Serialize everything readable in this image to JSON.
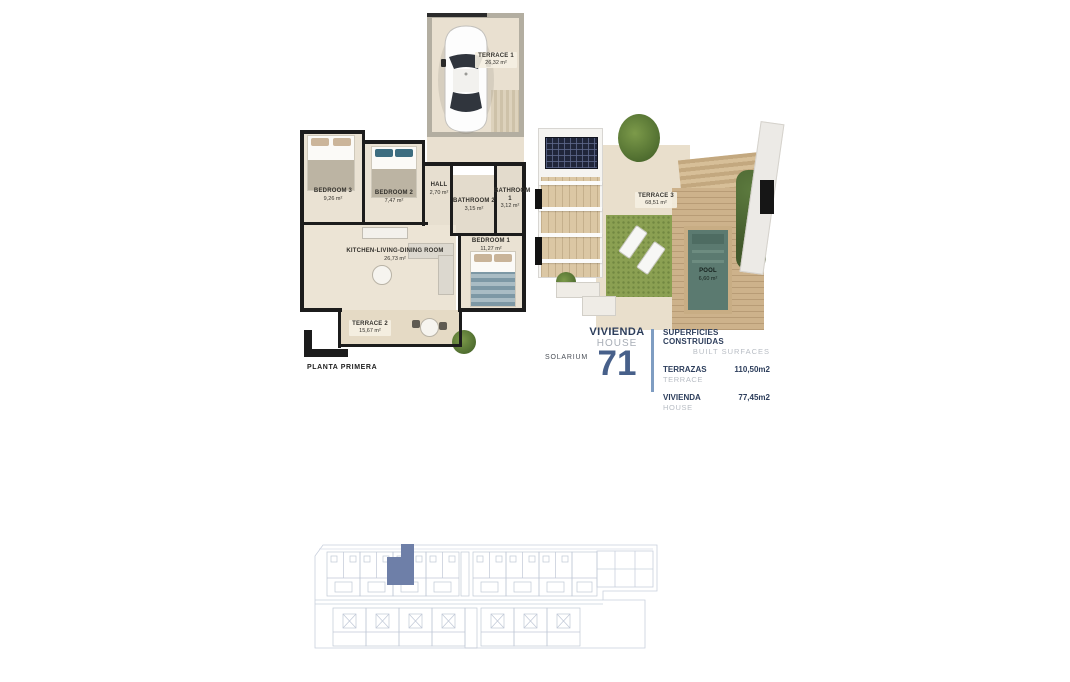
{
  "document": {
    "floor_label": "PLANTA PRIMERA",
    "solarium_label": "SOLARIUM"
  },
  "unit": {
    "type_es": "VIVIENDA",
    "type_en": "HOUSE",
    "number": "71"
  },
  "surfaces": {
    "title_es": "SUPERFICIES CONSTRUIDAS",
    "title_en": "BUILT SURFACES",
    "rows": [
      {
        "label_es": "TERRAZAS",
        "label_en": "TERRACE",
        "value": "110,50m2"
      },
      {
        "label_es": "VIVIENDA",
        "label_en": "HOUSE",
        "value": "77,45m2"
      }
    ]
  },
  "rooms": {
    "terrace1": {
      "name": "TERRACE 1",
      "area": "26,32 m²"
    },
    "bedroom3": {
      "name": "BEDROOM 3",
      "area": "9,26 m²"
    },
    "bedroom2": {
      "name": "BEDROOM 2",
      "area": "7,47 m²"
    },
    "hall": {
      "name": "HALL",
      "area": "2,70 m²"
    },
    "bathroom2": {
      "name": "BATHROOM 2",
      "area": "3,15 m²"
    },
    "bathroom1": {
      "name": "BATHROOM 1",
      "area": "3,12 m²"
    },
    "bedroom1": {
      "name": "BEDROOM 1",
      "area": "11,27 m²"
    },
    "kitchen": {
      "name": "KITCHEN-LIVING-DINING ROOM",
      "area": "26,73 m²"
    },
    "terrace2": {
      "name": "TERRACE 2",
      "area": "15,67 m²"
    },
    "terrace3": {
      "name": "TERRACE 3",
      "area": "68,51 m²"
    },
    "pool": {
      "name": "POOL",
      "area": "6,60 m²"
    }
  },
  "colors": {
    "accent_navy": "#2d3e5c",
    "secondary_gray": "#b8bdc4",
    "unit_number_blue": "#47608a",
    "divider_blue": "#7f9dc2",
    "siteplan_line": "#c9d0dd",
    "siteplan_highlight": "#6e7fa8",
    "floor_beige": "#e9e0d0",
    "wall_black": "#1c1c1c",
    "pool_teal": "#5b7a70",
    "grass_green": "#8ba052"
  }
}
